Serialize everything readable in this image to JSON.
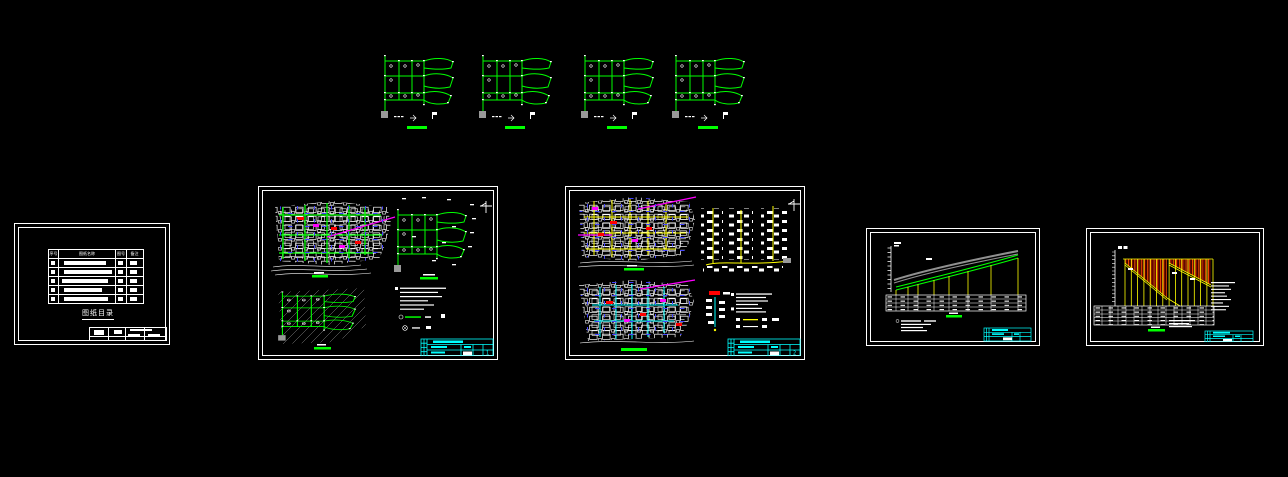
{
  "app": {
    "type": "cad-drawing-canvas",
    "background": "#000000"
  },
  "colors": {
    "net_green": "#00ff00",
    "net_yellow": "#ffff00",
    "net_cyan": "#00ffff",
    "accent_magenta": "#ff00ff",
    "mark_blue": "#4343ff",
    "block_red": "#ff0000",
    "ground_gray": "#999999",
    "hatch_orange": "#ff4d00",
    "titleblock_cyan": "#00ffff",
    "line_white": "#ffffff"
  },
  "top_row": {
    "diagram_count": 4
  },
  "catalog_sheet": {
    "title": "图纸目录",
    "table": {
      "headers": [
        "序号",
        "图纸名称",
        "图号",
        "备注"
      ],
      "row_count": 5
    }
  },
  "plan_sheet_1": {
    "sheet_no": "1"
  },
  "plan_sheet_2": {
    "sheet_no": "2"
  },
  "profile_sheet_1": {
    "sheet_no": ""
  },
  "profile_sheet_2": {
    "sheet_no": ""
  }
}
